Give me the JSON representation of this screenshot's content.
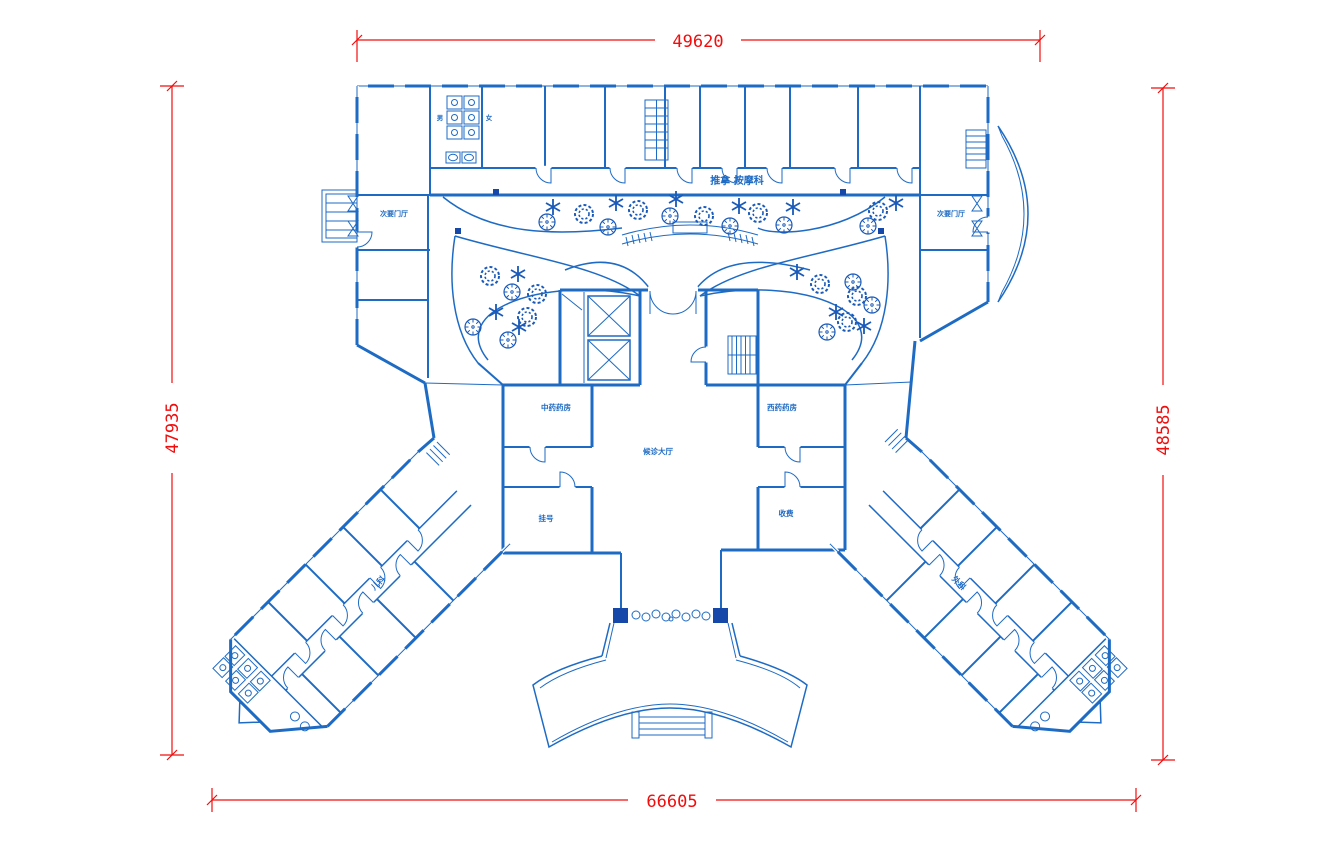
{
  "plan": {
    "dimensions": {
      "top": "49620",
      "bottom": "66605",
      "left": "47935",
      "right": "48585"
    },
    "labels": {
      "top_department": "推拿 按摩科",
      "left_foyer": "次要门厅",
      "right_foyer": "次要门厅",
      "male_wc": "男",
      "female_wc": "女",
      "chinese_pharmacy": "中药药房",
      "western_pharmacy": "西药药房",
      "waiting_hall": "候诊大厅",
      "registration": "挂号",
      "cashier": "收费",
      "left_wing_dept": "儿科",
      "right_wing_dept": "外科"
    },
    "colors": {
      "line": "#1e6bc4",
      "fill_dark": "#1548a8",
      "dimension": "#f20d0d",
      "background": "#ffffff"
    }
  }
}
